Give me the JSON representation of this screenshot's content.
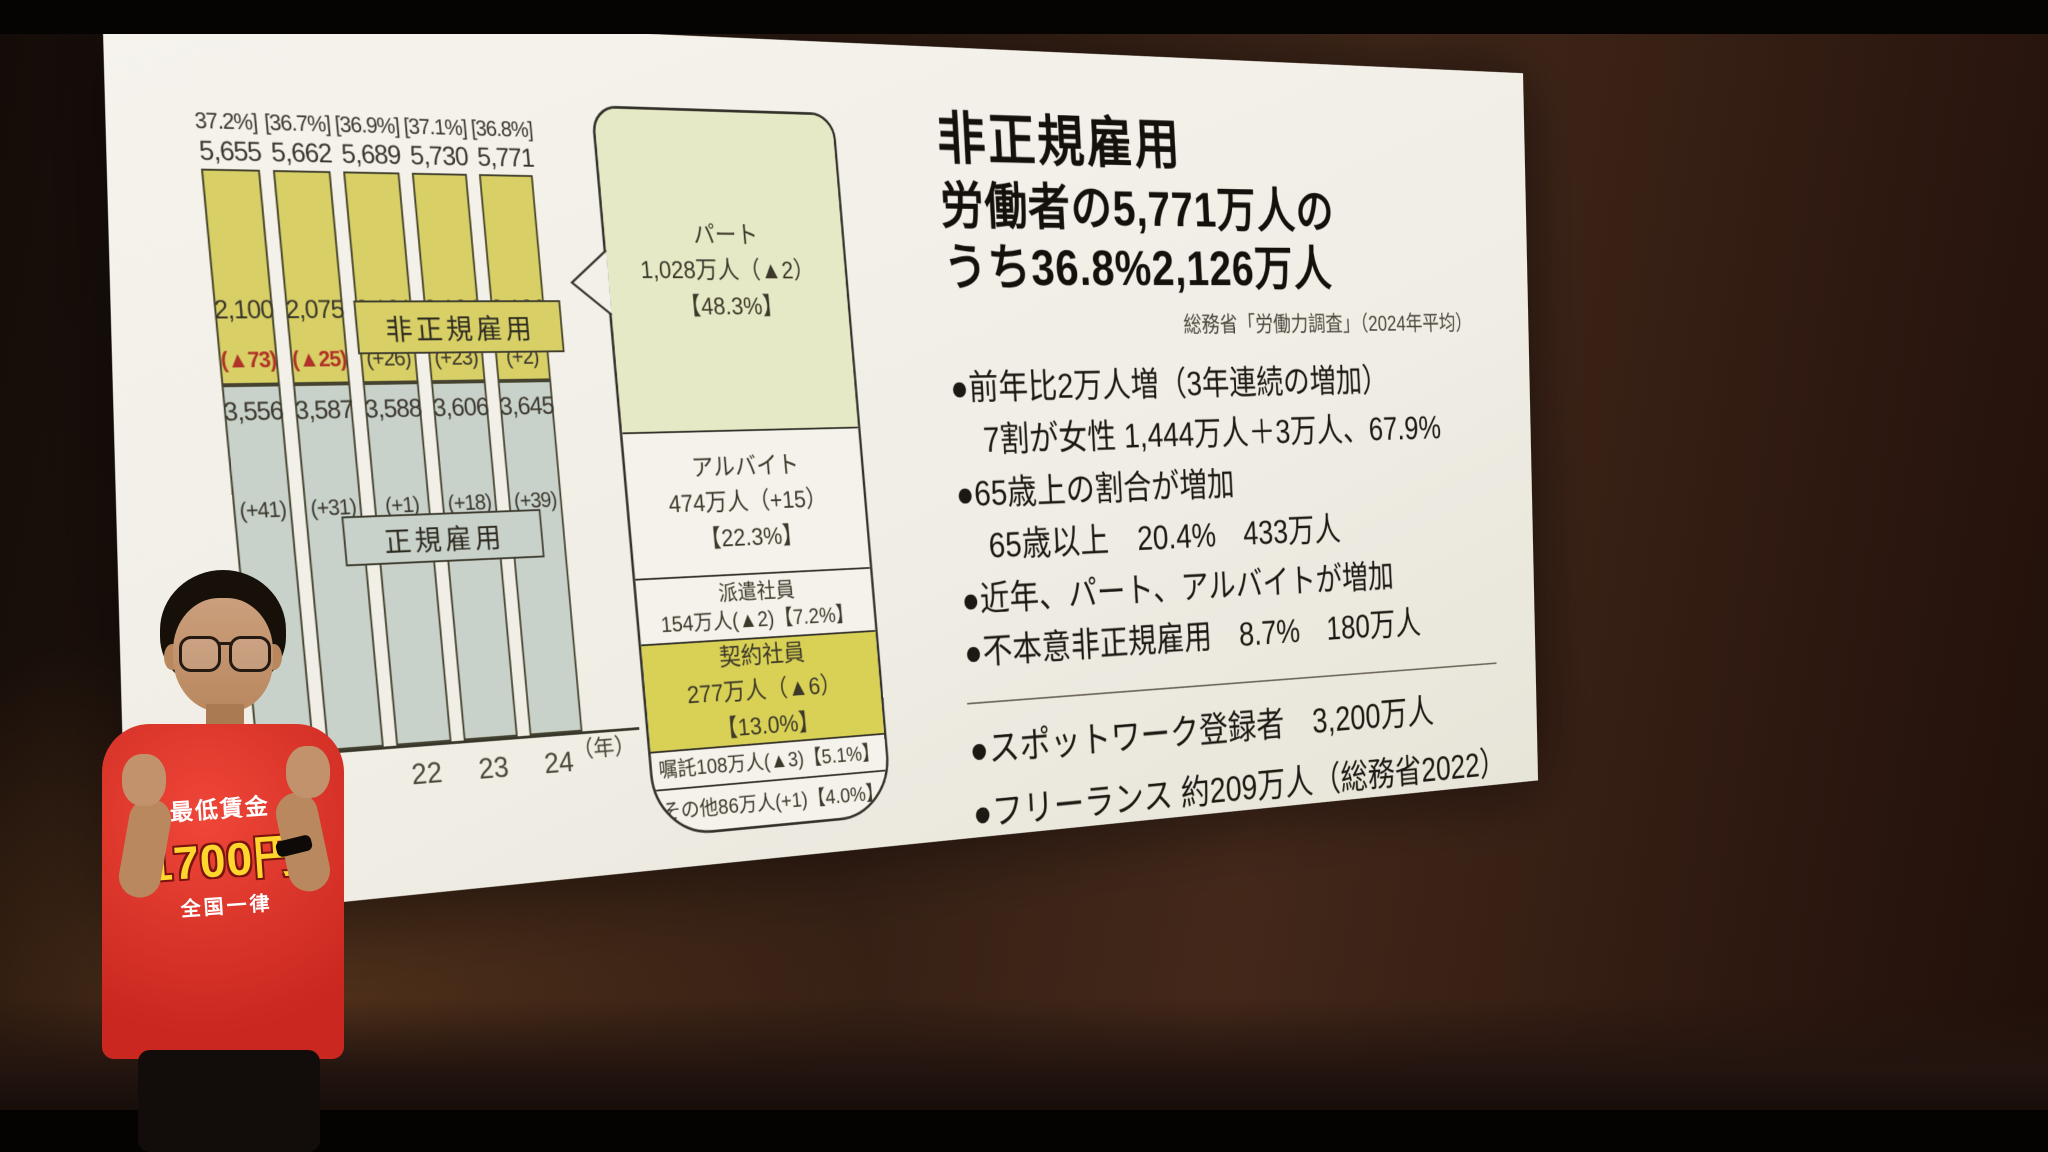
{
  "slide": {
    "chart": {
      "nonregular_label": "非正規雇用",
      "regular_label": "正規雇用",
      "axis_unit": "（年）",
      "bars": [
        {
          "pct": "37.2%]",
          "total": "5,655",
          "nr": "2,100",
          "nr_chg": "(▲73)",
          "r": "3,556",
          "r_chg": "(+41)",
          "year": ""
        },
        {
          "pct": "[36.7%]",
          "total": "5,662",
          "nr": "2,075",
          "nr_chg": "(▲25)",
          "r": "3,587",
          "r_chg": "(+31)",
          "year": ""
        },
        {
          "pct": "[36.9%]",
          "total": "5,689",
          "nr": "2,101",
          "nr_chg": "(+26)",
          "r": "3,588",
          "r_chg": "(+1)",
          "year": "22"
        },
        {
          "pct": "[37.1%]",
          "total": "5,730",
          "nr": "2,124",
          "nr_chg": "(+23)",
          "r": "3,606",
          "r_chg": "(+18)",
          "year": "23"
        },
        {
          "pct": "[36.8%]",
          "total": "5,771",
          "nr": "2,126",
          "nr_chg": "(+2)",
          "r": "3,645",
          "r_chg": "(+39)",
          "year": "24"
        }
      ]
    },
    "breakdown": {
      "rows": [
        {
          "l1": "パート",
          "l2": "1,028万人（▲2）",
          "l3": "【48.3%】"
        },
        {
          "l1": "アルバイト",
          "l2": "474万人（+15）",
          "l3": "【22.3%】"
        },
        {
          "l1": "派遣社員",
          "l2": "154万人(▲2)【7.2%】",
          "l3": ""
        },
        {
          "l1": "契約社員",
          "l2": "277万人（▲6）",
          "l3": "【13.0%】"
        },
        {
          "l1": "嘱託108万人(▲3)【5.1%】",
          "l2": "",
          "l3": ""
        },
        {
          "l1": "その他86万人(+1)【4.0%】",
          "l2": "",
          "l3": ""
        }
      ]
    },
    "right": {
      "title": "非正規雇用",
      "line2": "労働者の5,771万人の",
      "line3": "うち36.8%2,126万人",
      "source": "総務省「労働力調査」（2024年平均）",
      "bullets": [
        "●前年比2万人増（3年連続の増加）",
        "　7割が女性 1,444万人＋3万人、67.9%",
        "●65歳上の割合が増加",
        "　65歳以上　20.4%　433万人",
        "●近年、パート、アルバイトが増加",
        "●不本意非正規雇用　8.7%　180万人"
      ],
      "bottom": [
        "●スポットワーク登録者　3,200万人",
        "●フリーランス 約209万人（総務省2022）"
      ]
    }
  },
  "presenter": {
    "shirt": [
      "最低賃金",
      "1700円",
      "全国一律"
    ]
  },
  "chart_data": {
    "type": "bar",
    "stacked": true,
    "title": "非正規雇用 労働者の5,771万人のうち36.8%2,126万人",
    "source": "総務省「労働力調査」（2024年平均）",
    "categories": [
      "",
      "",
      "22",
      "23",
      "24"
    ],
    "x_axis_unit": "（年）",
    "totals": [
      5655,
      5662,
      5689,
      5730,
      5771
    ],
    "nonregular_share_pct": [
      37.2,
      36.7,
      36.9,
      37.1,
      36.8
    ],
    "series": [
      {
        "name": "非正規雇用",
        "values": [
          2100,
          2075,
          2101,
          2124,
          2126
        ],
        "changes": [
          -73,
          -25,
          26,
          23,
          2
        ],
        "color": "#d8d066"
      },
      {
        "name": "正規雇用",
        "values": [
          3556,
          3587,
          3588,
          3606,
          3645
        ],
        "changes": [
          41,
          31,
          1,
          18,
          39
        ],
        "color": "#c9d2ca"
      }
    ],
    "grid": false,
    "legend_position": "labels-inside-chart",
    "breakdown_of_nonregular": [
      {
        "name": "パート",
        "value_man": 1028,
        "change": -2,
        "share_pct": 48.3
      },
      {
        "name": "アルバイト",
        "value_man": 474,
        "change": 15,
        "share_pct": 22.3
      },
      {
        "name": "派遣社員",
        "value_man": 154,
        "change": -2,
        "share_pct": 7.2
      },
      {
        "name": "契約社員",
        "value_man": 277,
        "change": -6,
        "share_pct": 13.0
      },
      {
        "name": "嘱託",
        "value_man": 108,
        "change": -3,
        "share_pct": 5.1
      },
      {
        "name": "その他",
        "value_man": 86,
        "change": 1,
        "share_pct": 4.0
      }
    ]
  }
}
